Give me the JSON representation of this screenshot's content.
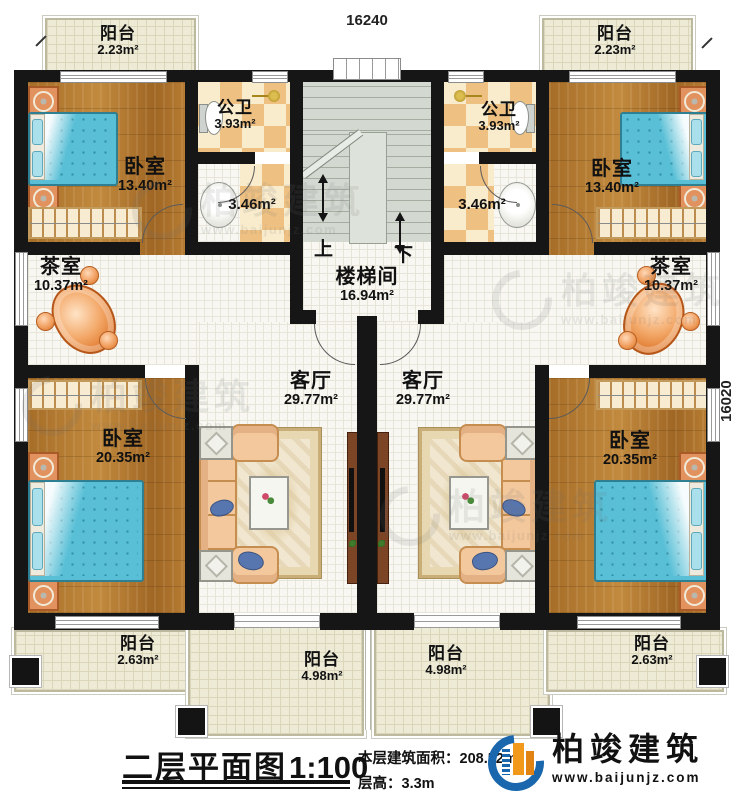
{
  "dimensions": {
    "top": "16240",
    "right": "16020"
  },
  "rooms": {
    "balcony_tl": {
      "name": "阳台",
      "area": "2.23m²"
    },
    "balcony_tr": {
      "name": "阳台",
      "area": "2.23m²"
    },
    "bedroom_tl": {
      "name": "卧室",
      "area": "13.40m²"
    },
    "bedroom_tr": {
      "name": "卧室",
      "area": "13.40m²"
    },
    "bath_l": {
      "name": "公卫",
      "area": "3.93m²"
    },
    "bath_r": {
      "name": "公卫",
      "area": "3.93m²"
    },
    "wash_l": {
      "area": "3.46m²"
    },
    "wash_r": {
      "area": "3.46m²"
    },
    "stairwell": {
      "name": "楼梯间",
      "area": "16.94m²",
      "up_label": "上",
      "down_label": "下"
    },
    "tea_l": {
      "name": "茶室",
      "area": "10.37m²"
    },
    "tea_r": {
      "name": "茶室",
      "area": "10.37m²"
    },
    "living_l": {
      "name": "客厅",
      "area": "29.77m²"
    },
    "living_r": {
      "name": "客厅",
      "area": "29.77m²"
    },
    "bedroom_bl": {
      "name": "卧室",
      "area": "20.35m²"
    },
    "bedroom_br": {
      "name": "卧室",
      "area": "20.35m²"
    },
    "balcony_bl": {
      "name": "阳台",
      "area": "2.63m²"
    },
    "balcony_bcl": {
      "name": "阳台",
      "area": "4.98m²"
    },
    "balcony_bcr": {
      "name": "阳台",
      "area": "4.98m²"
    },
    "balcony_br": {
      "name": "阳台",
      "area": "2.63m²"
    }
  },
  "footer": {
    "plan_title": "二层平面图",
    "scale": "1:100",
    "area_label": "本层建筑面积：",
    "area_value": "208.52m²",
    "height_label": "层高：",
    "height_value": "3.3m"
  },
  "brand": {
    "name": "柏竣建筑",
    "website": "www.baijunjz.com"
  },
  "watermark": {
    "name": "柏竣建筑",
    "website": "www.baijunjz.com"
  },
  "colors": {
    "wall": "#161616",
    "wood": "#b0772e",
    "tile": "#f8f7f2",
    "balcony": "#edead6",
    "checker": "#eec183",
    "stair": "#d3d9d1",
    "bed": "#58bfd6",
    "brand_blue": "#1a67ad",
    "brand_orange": "#f2991c"
  }
}
